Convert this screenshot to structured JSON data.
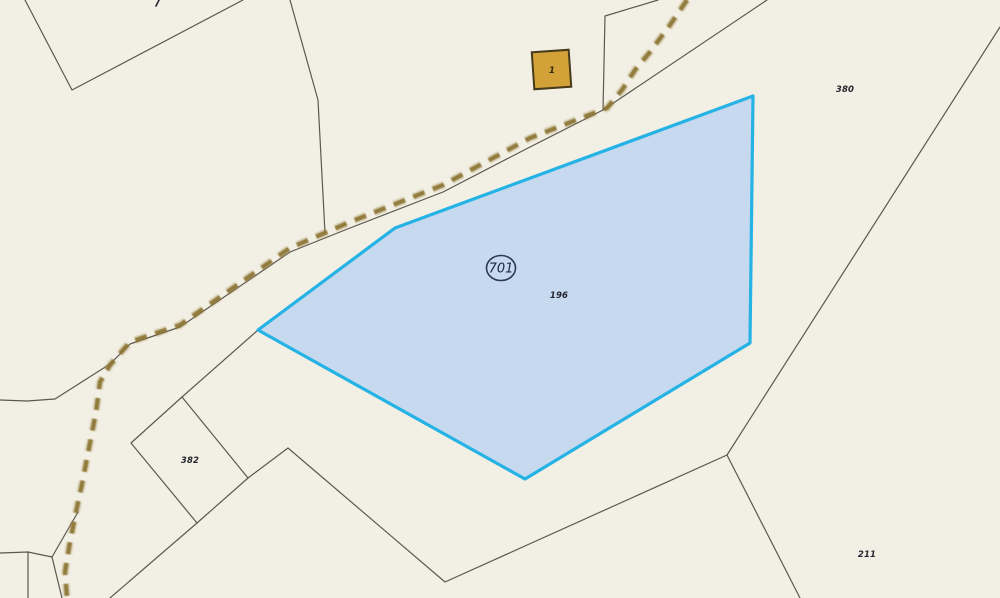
{
  "map": {
    "colors": {
      "background": "#f2efe4",
      "boundary": "#504b42",
      "road_dash": "#8b7433",
      "road_halo": "#a5905a",
      "selected_stroke": "#25b2e5",
      "selected_fill": "#c7d9ef",
      "label": "#262630",
      "badge": "#2c3852",
      "building_fill": "#d2a137",
      "building_stroke": "#463a1b"
    },
    "boundaries": [
      {
        "name": "nw-corner-boundary",
        "points": [
          [
            25,
            0
          ],
          [
            72,
            90
          ],
          [
            243,
            0
          ]
        ]
      },
      {
        "name": "north-boundary",
        "points": [
          [
            290,
            0
          ],
          [
            318,
            100
          ],
          [
            325,
            233
          ]
        ]
      },
      {
        "name": "building-east-boundary",
        "points": [
          [
            658,
            0
          ],
          [
            605,
            16
          ],
          [
            603,
            110
          ]
        ]
      },
      {
        "name": "road-edge-boundary",
        "points": [
          [
            767,
            0
          ],
          [
            603,
            110
          ],
          [
            530,
            147
          ],
          [
            443,
            192
          ],
          [
            350,
            228
          ],
          [
            290,
            252
          ],
          [
            230,
            293
          ],
          [
            180,
            327
          ],
          [
            130,
            344
          ],
          [
            110,
            364
          ],
          [
            55,
            399
          ],
          [
            27,
            401
          ],
          [
            0,
            400
          ]
        ]
      },
      {
        "name": "south-long-boundary",
        "points": [
          [
            110,
            598
          ],
          [
            197,
            523
          ],
          [
            248,
            478
          ],
          [
            288,
            448
          ],
          [
            445,
            582
          ],
          [
            727,
            455
          ],
          [
            1000,
            27
          ]
        ]
      },
      {
        "name": "southeast-branch-boundary",
        "points": [
          [
            727,
            455
          ],
          [
            800,
            598
          ]
        ]
      },
      {
        "name": "parcel-382-west-boundary",
        "points": [
          [
            182,
            397
          ],
          [
            131,
            443
          ],
          [
            197,
            523
          ]
        ]
      },
      {
        "name": "parcel-382-east-boundary",
        "points": [
          [
            248,
            478
          ],
          [
            182,
            397
          ],
          [
            258,
            330
          ]
        ]
      },
      {
        "name": "sw-corner-boundary-a",
        "points": [
          [
            0,
            553
          ],
          [
            28,
            552
          ],
          [
            52,
            557
          ]
        ]
      },
      {
        "name": "sw-corner-boundary-b",
        "points": [
          [
            28,
            552
          ],
          [
            28,
            598
          ]
        ]
      },
      {
        "name": "sw-corner-boundary-c",
        "points": [
          [
            52,
            557
          ],
          [
            62,
            598
          ]
        ]
      },
      {
        "name": "sw-corner-boundary-d",
        "points": [
          [
            52,
            557
          ],
          [
            78,
            512
          ]
        ]
      }
    ],
    "road": {
      "name": "dirt-road",
      "dash_points": [
        [
          687,
          0
        ],
        [
          670,
          25
        ],
        [
          650,
          52
        ],
        [
          635,
          70
        ],
        [
          622,
          90
        ],
        [
          607,
          108
        ],
        [
          530,
          138
        ],
        [
          443,
          185
        ],
        [
          350,
          222
        ],
        [
          290,
          248
        ],
        [
          230,
          290
        ],
        [
          180,
          325
        ],
        [
          130,
          342
        ],
        [
          110,
          365
        ],
        [
          100,
          382
        ],
        [
          96,
          412
        ],
        [
          89,
          448
        ],
        [
          82,
          484
        ],
        [
          76,
          512
        ],
        [
          70,
          542
        ],
        [
          65,
          572
        ],
        [
          67,
          598
        ]
      ]
    },
    "selected_parcel": {
      "id_label": "701",
      "area_label": "196",
      "points": [
        [
          753,
          96
        ],
        [
          395,
          228
        ],
        [
          258,
          330
        ],
        [
          525,
          479
        ],
        [
          750,
          343
        ]
      ],
      "badge": {
        "cx": 501,
        "cy": 268,
        "rx": 14.5,
        "ry": 12.5
      },
      "badge_label_pos": {
        "x": 501,
        "y": 272.5
      },
      "area_label_pos": {
        "x": 559,
        "y": 298
      }
    },
    "parcel_labels": [
      {
        "text": "380",
        "x": 845,
        "y": 92
      },
      {
        "text": "382",
        "x": 190,
        "y": 463
      },
      {
        "text": "211",
        "x": 867,
        "y": 557
      }
    ],
    "building": {
      "label": "1",
      "x": 533,
      "y": 51,
      "w": 37,
      "h": 37,
      "rotation": -4,
      "label_x": 552,
      "label_y": 73
    },
    "edge_tick": {
      "points": [
        [
          156,
          6
        ],
        [
          159,
          0
        ]
      ]
    }
  }
}
